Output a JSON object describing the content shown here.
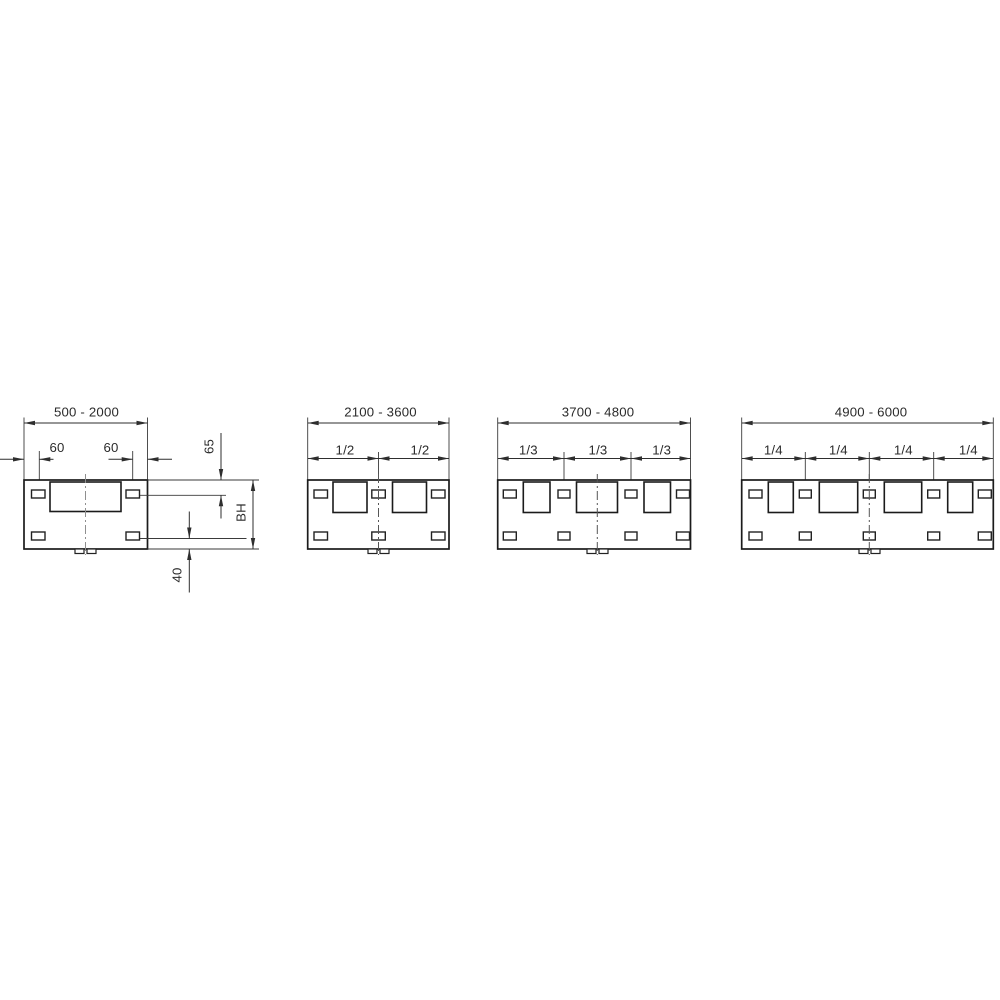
{
  "diagram_type": "technical-dimension-drawing",
  "panels": [
    {
      "range": "500 - 2000",
      "dims": {
        "slot_offset_left": "60",
        "slot_offset_right": "60",
        "top_offset": "65",
        "height": "BH",
        "bottom_offset": "40"
      },
      "cutouts": {
        "large_rect": 1,
        "top_slots": 2,
        "bottom_slots": 2,
        "din_tabs": 2
      }
    },
    {
      "range": "2100 - 3600",
      "fractions": [
        "1/2",
        "1/2"
      ],
      "cutouts": {
        "squares": 2,
        "top_slots": 3,
        "bottom_slots": 3,
        "din_tabs": 2
      }
    },
    {
      "range": "3700 - 4800",
      "fractions": [
        "1/3",
        "1/3",
        "1/3"
      ],
      "cutouts": {
        "squares": 3,
        "top_slots": 4,
        "bottom_slots": 4,
        "din_tabs": 2
      }
    },
    {
      "range": "4900 - 6000",
      "fractions": [
        "1/4",
        "1/4",
        "1/4",
        "1/4"
      ],
      "cutouts": {
        "squares": 4,
        "top_slots": 5,
        "bottom_slots": 5,
        "din_tabs": 2
      }
    }
  ],
  "colors": {
    "background": "#ffffff",
    "dimension_line": "#2e2e2e",
    "plate_outline": "#1b1b1b",
    "centerline": "#8f8f8f"
  }
}
